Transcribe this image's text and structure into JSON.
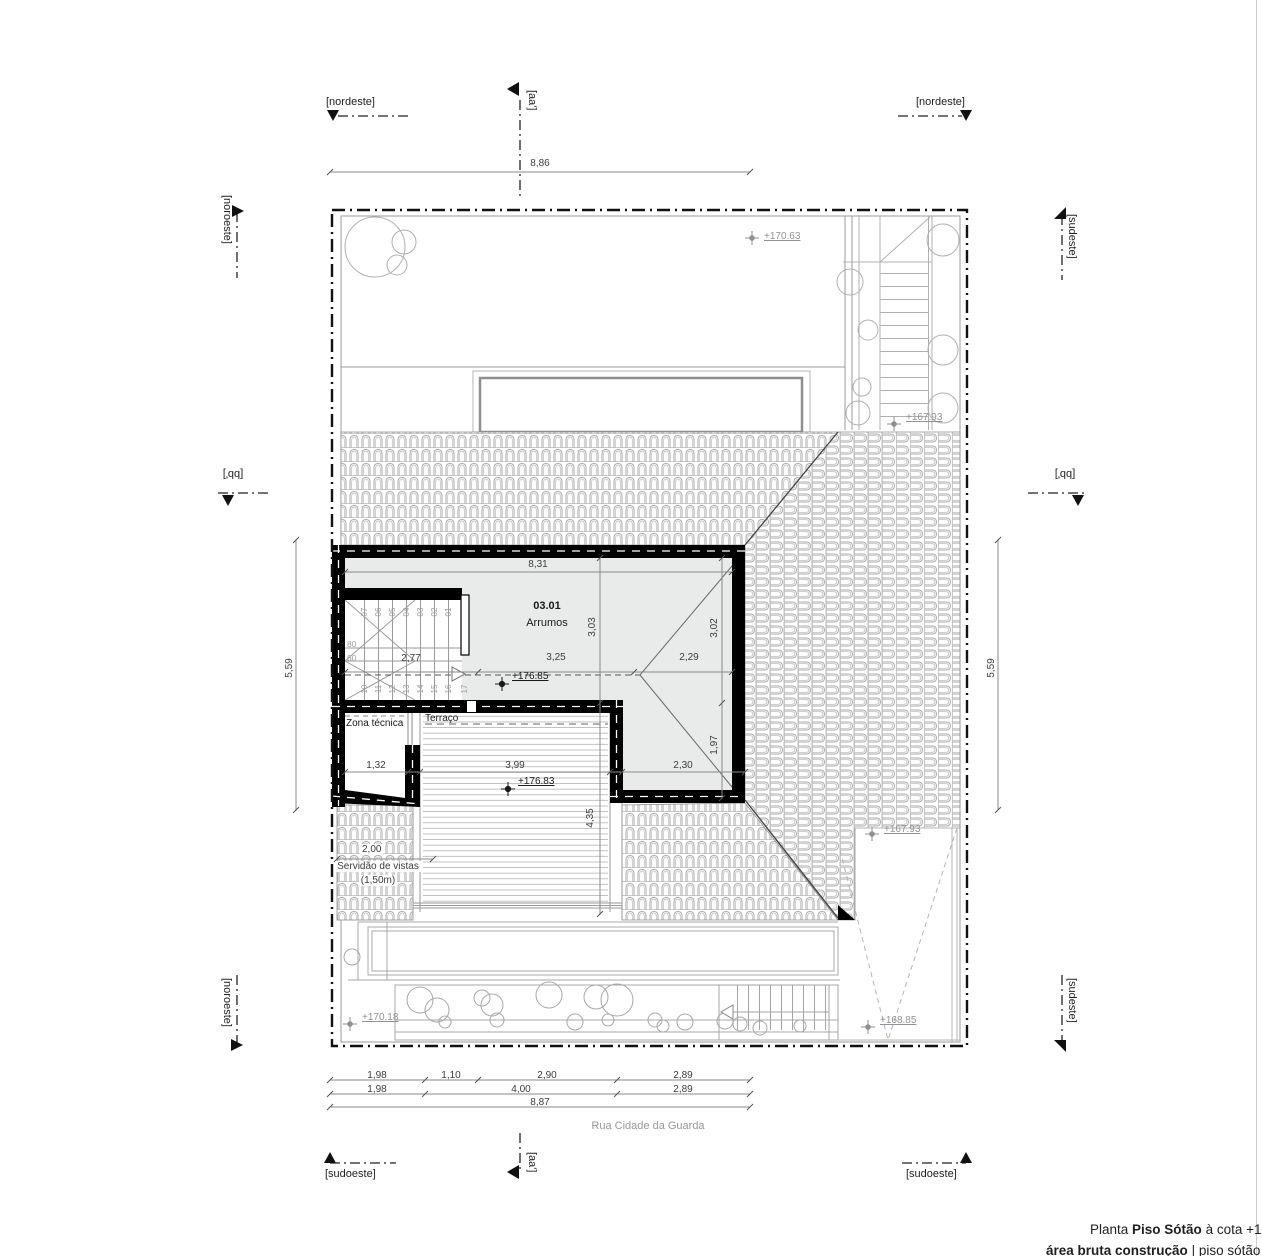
{
  "labels": {
    "nordeste": "[nordeste]",
    "noroeste": "[noroeste]",
    "sudeste": "[sudeste]",
    "sudoeste": "[sudoeste]",
    "section_aa": "[aa']",
    "section_bb": "[bb']"
  },
  "street": "Rua Cidade da Guarda",
  "rooms": {
    "storage_number": "03.01",
    "storage_name": "Arrumos",
    "tech": "Zona técnica",
    "terrace": "Terraço",
    "easement_line1": "Servidão de vistas",
    "easement_line2": "(1,50m)"
  },
  "levels": {
    "garden_ne": "+170.63",
    "stair_ne": "+167.93",
    "attic": "+176.85",
    "terrace": "+176.83",
    "ramp_top": "+167.93",
    "garden_sw": "+170.18",
    "ramp_bottom": "+168.85"
  },
  "dims": {
    "top": "8,86",
    "side_left": "5,59",
    "side_right": "5,59",
    "room_width": "8,31",
    "stair_w": "2,77",
    "room_a": "3,25",
    "room_b": "2,29",
    "room_h_left": "3,03",
    "room_h_right": "3,02",
    "tech_w": "1,32",
    "terrace_w": "3,99",
    "right_w": "2,30",
    "right_h": "1,97",
    "terrace_h": "4,35",
    "easement_w": "2,00",
    "bottom_r1": [
      "1,98",
      "1,10",
      "2,90",
      "2,89"
    ],
    "bottom_r2": [
      "1,98",
      "4,00",
      "2,89"
    ],
    "bottom_total": "8,87"
  },
  "stairs": {
    "up": [
      "07",
      "06",
      "05",
      "04",
      "03",
      "02",
      "01"
    ],
    "down": [
      "10",
      "11",
      "12",
      "13",
      "14",
      "15",
      "16"
    ],
    "last": "17",
    "w1": "80",
    "w2": "60"
  },
  "title": {
    "p1": "Planta",
    "p2": "Piso Sótão",
    "p3": "à cota +178",
    "a1": "área bruta construção",
    "a2": "| piso sótão = 03"
  }
}
